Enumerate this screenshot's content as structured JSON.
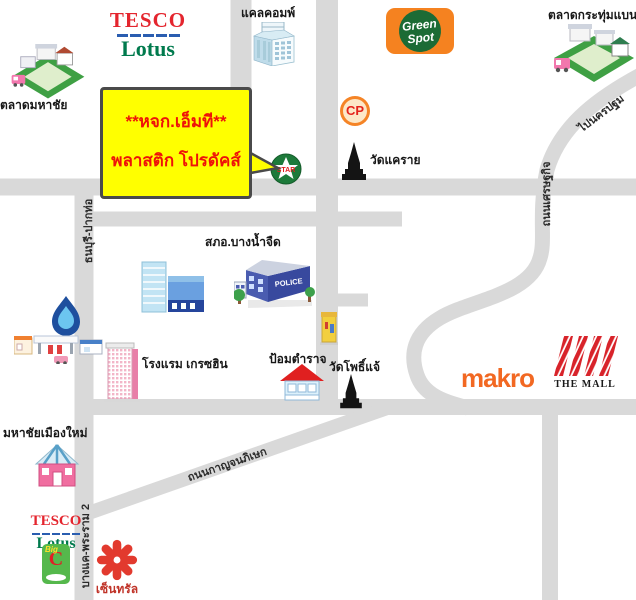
{
  "callout": {
    "line1": "**หจก.เอ็มที**",
    "line2": "พลาสติก โปรดัคส์"
  },
  "logos": {
    "tesco": {
      "name": "TESCO",
      "lotus": "Lotus"
    },
    "green_spot": {
      "green": "Green",
      "spot": "Spot"
    },
    "cp": "CP",
    "star": "STAR",
    "makro": "makro",
    "the_mall": "THE MALL",
    "central": "เซ็นทรัล",
    "big_c": "C",
    "big_c_script": "Big",
    "police_sign": "POLICE"
  },
  "places": {
    "calcomp": "แคลคอมพ์",
    "talad_krathum_baen": "ตลาดกระทุ่มแบน",
    "talad_mahachai": "ตลาดมหาชัย",
    "wat_khae_rai": "วัดแคราย",
    "police_station": "สภอ.บางน้ำจืด",
    "hotel_grace_hin": "โรงแรม เกรซฮิน",
    "police_box": "ป้อมตำราจ",
    "wat_pho_chae": "วัดโพธิ์แจ้",
    "mahachai_muang_mai": "มหาชัยเมืองใหม่"
  },
  "roads": {
    "thonburi_paktho": "ธนบุรี-ปากท่อ",
    "setthakit": "ถนนเศรษฐกิจ",
    "kanchanaphisek": "ถนนกาญจนภิเษก",
    "to_nakhon_pathom": "ไปนครปฐม",
    "bangkhae_rama2": "บางแค-พระราม 2"
  },
  "colors": {
    "road": "#d9d9d9",
    "callout_bg": "#ffff00",
    "callout_text": "#ee1309",
    "tesco_red": "#e4252e",
    "tesco_blue": "#2a5db0",
    "lotus_green": "#007a4d",
    "greenspot_orange": "#f58220",
    "greenspot_green": "#1c6b35",
    "cp_orange": "#f58426",
    "makro_orange": "#f26822",
    "mall_red": "#d8232a",
    "central_red": "#e23a2e",
    "bigc_green": "#55b84c",
    "star_green": "#1d7a3a",
    "ptt_blue": "#1e4f9e"
  }
}
